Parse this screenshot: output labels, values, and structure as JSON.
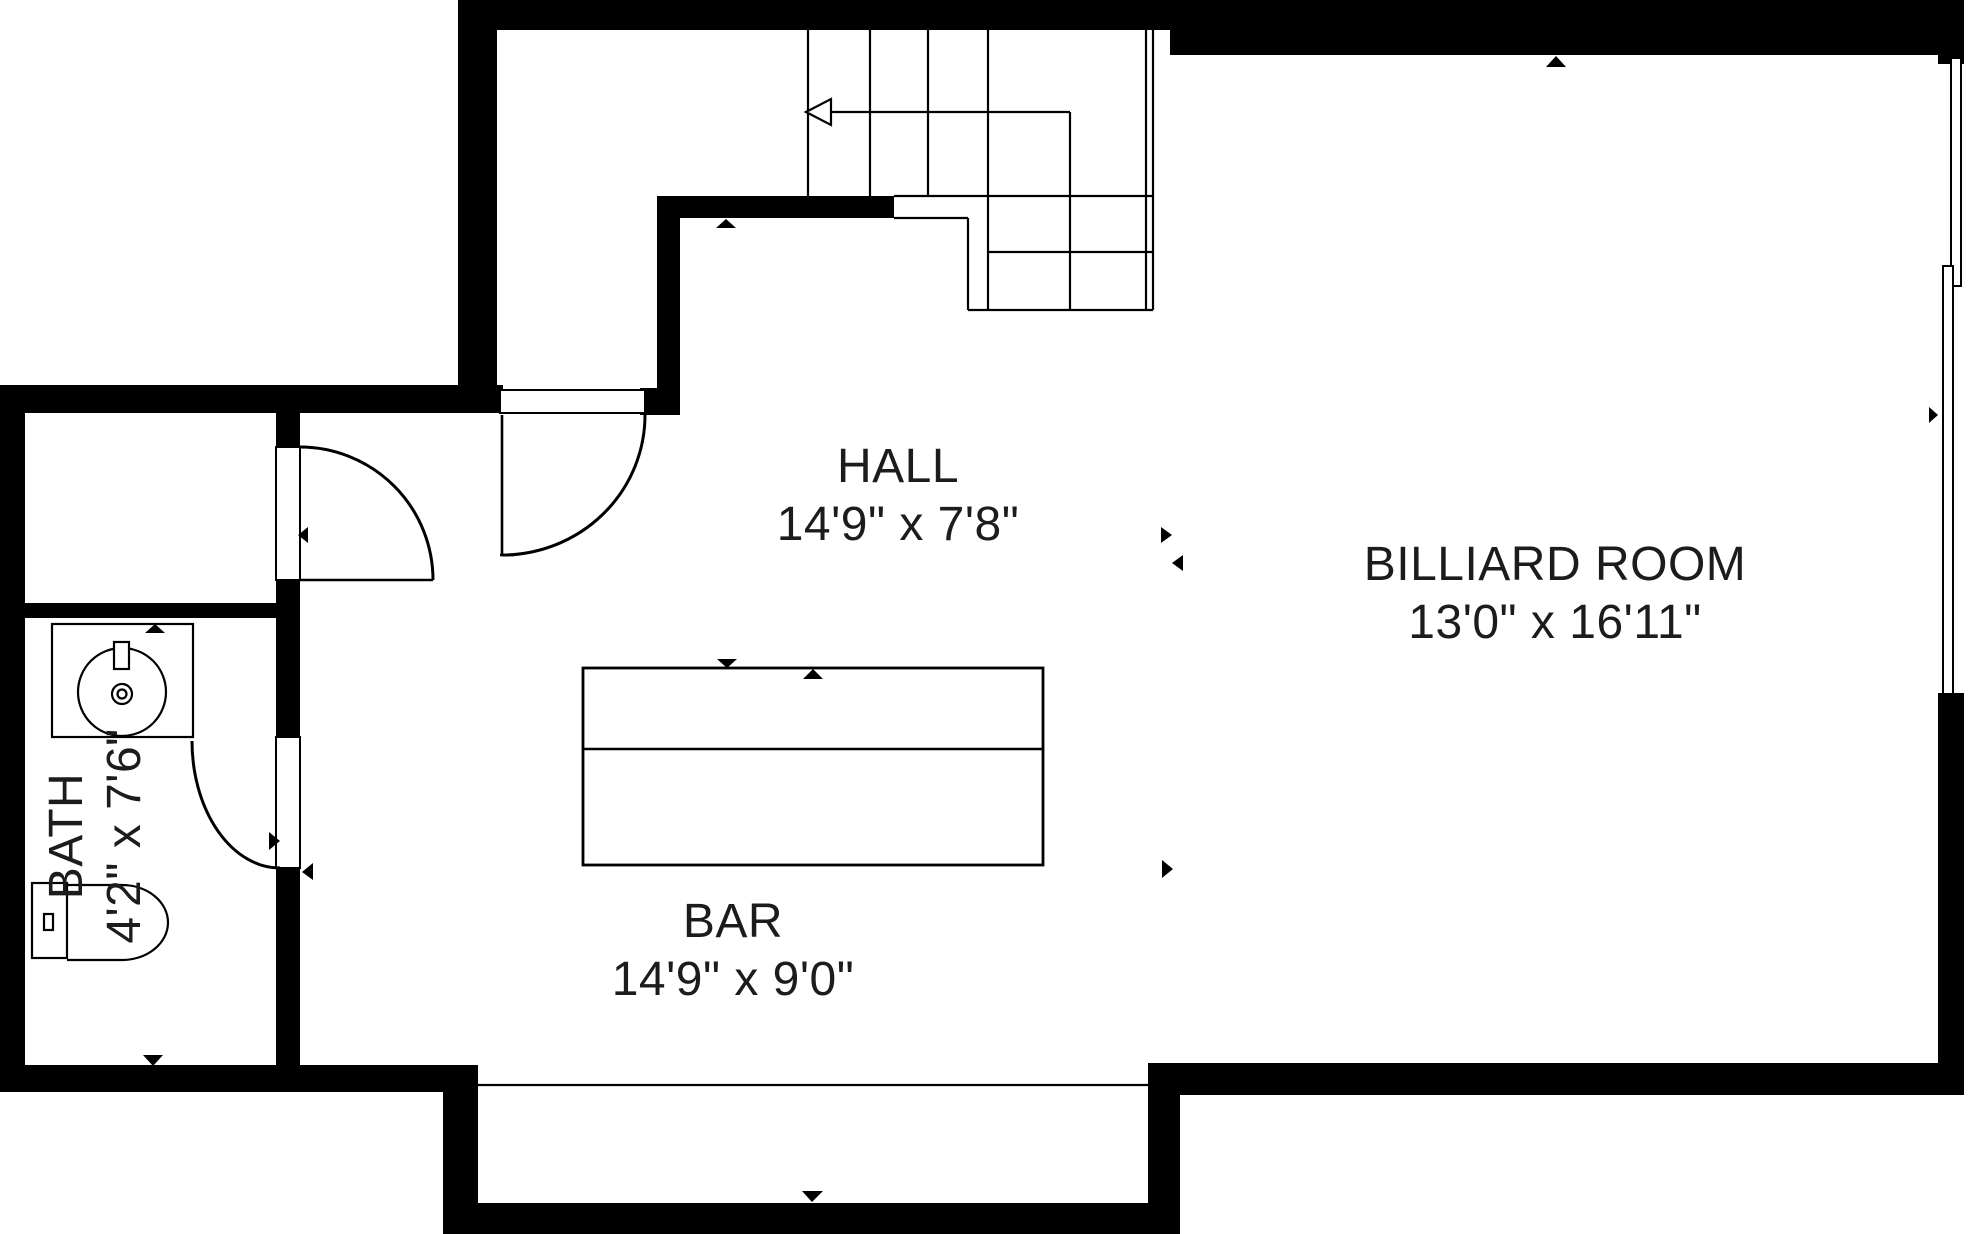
{
  "floorplan": {
    "type": "residential-floor-plan",
    "rooms": [
      {
        "name": "HALL",
        "dimensions": "14'9\" x 7'8\""
      },
      {
        "name": "BILLIARD ROOM",
        "dimensions": "13'0\" x 16'11\""
      },
      {
        "name": "BAR",
        "dimensions": "14'9\" x 9'0\""
      },
      {
        "name": "BATH",
        "dimensions": "4'2\" x 7'6\""
      }
    ],
    "features": {
      "staircase": "L-shaped staircase with winders, walk-line arrow pointing left (down)",
      "doors": [
        "hall top door",
        "closet door to hall",
        "bath door"
      ],
      "fixtures": [
        "round vessel sink on vanity",
        "toilet"
      ],
      "bar_counter": "rectangular counter with ledge divider",
      "windows": "two windows on right wall of billiard room"
    },
    "colors": {
      "wall": "#000000",
      "line": "#000000",
      "text": "#1c1c1c",
      "background": "#ffffff"
    }
  }
}
